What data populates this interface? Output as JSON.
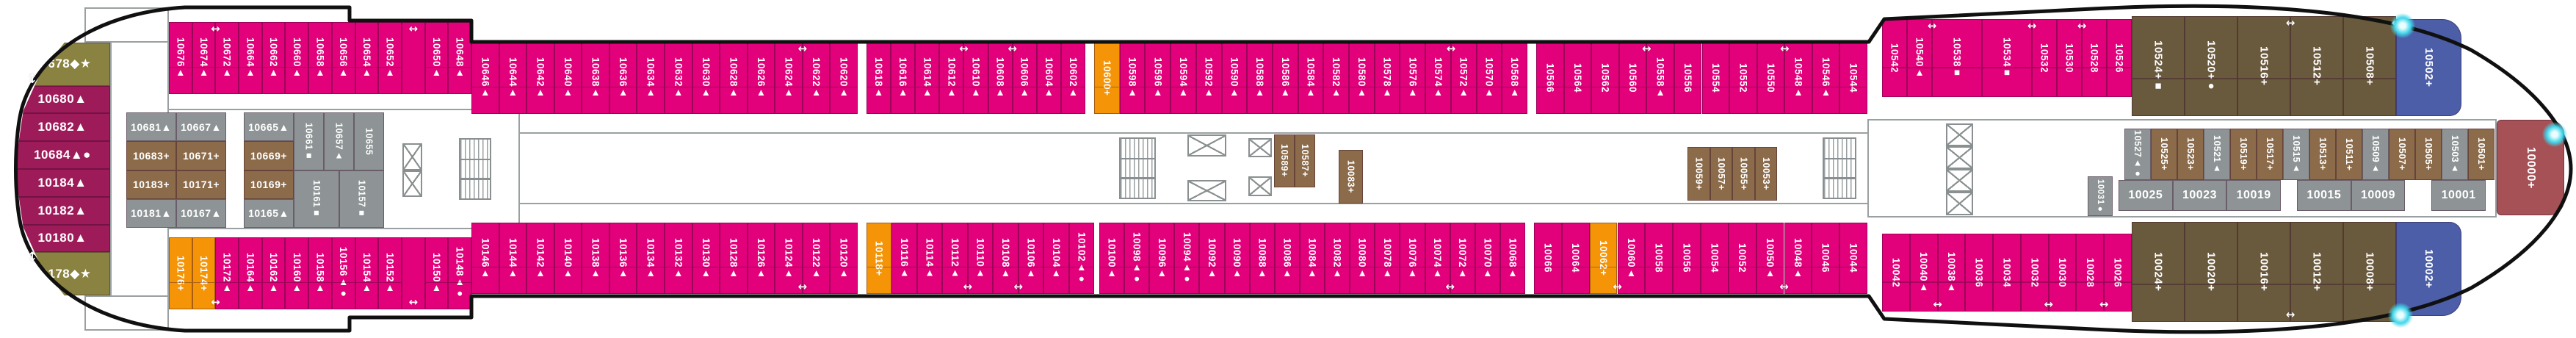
{
  "deck_plan_name": "cruise-ship-deck-10-cabin-plan",
  "icons": {
    "arrow_h": "↔",
    "arrow_v": "↕",
    "glow": "highlight-dot"
  },
  "colors": {
    "pink": "#e2017b",
    "berry": "#9e1b5a",
    "olive": "#8a8240",
    "gray": "#8e9495",
    "brown": "#8b6b4a",
    "hbrown": "#6a5a3d",
    "orange": "#f49406",
    "blue": "#4b5ea7",
    "red": "#a55156"
  },
  "cabins": {
    "lb": [
      {
        "n": "10678",
        "s": "◆★",
        "c": "olive",
        "hf": 1.55
      },
      {
        "n": "10680",
        "s": "▲",
        "c": "berry"
      },
      {
        "n": "10682",
        "s": "▲",
        "c": "berry"
      },
      {
        "n": "10684",
        "s": "▲●",
        "c": "berry"
      },
      {
        "n": "10184",
        "s": "▲",
        "c": "berry"
      },
      {
        "n": "10182",
        "s": "▲",
        "c": "berry"
      },
      {
        "n": "10180",
        "s": "▲",
        "c": "berry"
      },
      {
        "n": "10178",
        "s": "◆★",
        "c": "olive",
        "hf": 1.55
      }
    ],
    "t1": [
      {
        "n": "10676",
        "s": "▲",
        "c": "pink"
      },
      {
        "n": "10674",
        "s": "▲",
        "c": "pink",
        "a": 1
      },
      {
        "n": "10672",
        "s": "▲",
        "c": "pink"
      },
      {
        "n": "10664",
        "s": "▲",
        "c": "pink"
      },
      {
        "n": "10662",
        "s": "▲",
        "c": "pink"
      },
      {
        "n": "10660",
        "s": "▲",
        "c": "pink"
      },
      {
        "n": "10658",
        "s": "▲",
        "c": "pink"
      },
      {
        "n": "10656",
        "s": "▲",
        "c": "pink"
      },
      {
        "n": "10654",
        "s": "▲",
        "c": "pink"
      },
      {
        "n": "10652",
        "s": "▲",
        "c": "pink"
      },
      {
        "sp": 1,
        "c": "pink",
        "a": 1
      },
      {
        "n": "10650",
        "s": "▲",
        "c": "pink"
      },
      {
        "n": "10648",
        "s": "▲",
        "c": "pink"
      }
    ],
    "t2": [
      {
        "n": "10646",
        "s": "▲",
        "c": "pink"
      },
      {
        "n": "10644",
        "s": "▲",
        "c": "pink"
      },
      {
        "n": "10642",
        "s": "▲",
        "c": "pink"
      },
      {
        "n": "10640",
        "s": "▲",
        "c": "pink"
      },
      {
        "n": "10638",
        "s": "▲",
        "c": "pink"
      },
      {
        "n": "10636",
        "s": "▲",
        "c": "pink"
      },
      {
        "n": "10634",
        "s": "▲",
        "c": "pink"
      },
      {
        "n": "10632",
        "s": "▲",
        "c": "pink"
      },
      {
        "n": "10630",
        "s": "▲",
        "c": "pink"
      },
      {
        "n": "10628",
        "s": "▲",
        "c": "pink"
      },
      {
        "n": "10626",
        "s": "▲",
        "c": "pink"
      },
      {
        "n": "10624",
        "s": "▲",
        "c": "pink",
        "a": 1
      },
      {
        "n": "10622",
        "s": "▲",
        "c": "pink"
      },
      {
        "n": "10620",
        "s": "▲",
        "c": "pink"
      }
    ],
    "t3": [
      {
        "n": "10618",
        "s": "▲",
        "c": "pink"
      },
      {
        "n": "10616",
        "s": "▲",
        "c": "pink"
      },
      {
        "n": "10614",
        "s": "▲",
        "c": "pink"
      },
      {
        "n": "10612",
        "s": "▲",
        "c": "pink",
        "a": 1
      },
      {
        "n": "10610",
        "s": "▲",
        "c": "pink"
      },
      {
        "n": "10608",
        "s": "▲",
        "c": "pink",
        "a": 1
      },
      {
        "n": "10606",
        "s": "▲",
        "c": "pink"
      },
      {
        "n": "10604",
        "s": "▲",
        "c": "pink"
      },
      {
        "n": "10602",
        "s": "▲",
        "c": "pink"
      }
    ],
    "t4": [
      {
        "n": "10600",
        "s": "+",
        "c": "orange"
      },
      {
        "n": "10598",
        "s": "▲",
        "c": "pink"
      },
      {
        "n": "10596",
        "s": "▲",
        "c": "pink"
      },
      {
        "n": "10594",
        "s": "▲",
        "c": "pink"
      },
      {
        "n": "10592",
        "s": "▲",
        "c": "pink"
      },
      {
        "n": "10590",
        "s": "▲",
        "c": "pink"
      },
      {
        "n": "10588",
        "s": "▲",
        "c": "pink"
      },
      {
        "n": "10586",
        "s": "▲",
        "c": "pink"
      },
      {
        "n": "10584",
        "s": "▲",
        "c": "pink"
      },
      {
        "n": "10582",
        "s": "▲",
        "c": "pink"
      },
      {
        "n": "10580",
        "s": "▲",
        "c": "pink"
      },
      {
        "n": "10578",
        "s": "▲",
        "c": "pink"
      },
      {
        "n": "10576",
        "s": "▲",
        "c": "pink"
      },
      {
        "n": "10574",
        "s": "▲",
        "c": "pink",
        "a": 1
      },
      {
        "n": "10572",
        "s": "▲",
        "c": "pink"
      },
      {
        "n": "10570",
        "s": "▲",
        "c": "pink"
      },
      {
        "n": "10568",
        "s": "▲",
        "c": "pink"
      }
    ],
    "t5": [
      {
        "n": "10566",
        "s": "",
        "c": "pink"
      },
      {
        "n": "10564",
        "s": "",
        "c": "pink"
      },
      {
        "n": "10562",
        "s": "",
        "c": "pink"
      },
      {
        "n": "10560",
        "s": "",
        "c": "pink",
        "a": 1
      },
      {
        "n": "10558",
        "s": "▲",
        "c": "pink"
      },
      {
        "n": "10556",
        "s": "",
        "c": "pink"
      },
      {
        "n": "10554",
        "s": "",
        "c": "pink"
      },
      {
        "n": "10552",
        "s": "",
        "c": "pink"
      },
      {
        "n": "10550",
        "s": "",
        "c": "pink",
        "a": 1
      },
      {
        "n": "10548",
        "s": "▲",
        "c": "pink"
      },
      {
        "n": "10546",
        "s": "▲",
        "c": "pink"
      },
      {
        "n": "10544",
        "s": "",
        "c": "pink"
      }
    ],
    "t6": [
      {
        "n": "10542",
        "s": "",
        "c": "pink"
      },
      {
        "n": "10540",
        "s": "▲",
        "c": "pink",
        "a": 1
      },
      {
        "n": "10538",
        "s": "■",
        "c": "pink",
        "wf": 2
      },
      {
        "n": "10534",
        "s": "■",
        "c": "pink",
        "wf": 2,
        "a": 1
      },
      {
        "n": "10532",
        "s": "",
        "c": "pink"
      },
      {
        "n": "10530",
        "s": "",
        "c": "pink",
        "a": 1
      },
      {
        "n": "10528",
        "s": "",
        "c": "pink"
      },
      {
        "n": "10526",
        "s": "",
        "c": "pink"
      }
    ],
    "t7": [
      {
        "n": "10524",
        "s": "+■",
        "c": "hbrown"
      },
      {
        "n": "10520",
        "s": "+●",
        "c": "hbrown"
      },
      {
        "n": "10516",
        "s": "+",
        "c": "hbrown",
        "a": 1
      },
      {
        "n": "10512",
        "s": "+",
        "c": "hbrown"
      },
      {
        "n": "10508",
        "s": "+",
        "c": "hbrown",
        "a": 1
      }
    ],
    "t7b": [
      {
        "n": "10502",
        "s": "+",
        "c": "blue"
      }
    ],
    "b1": [
      {
        "n": "10176",
        "s": "+",
        "c": "orange"
      },
      {
        "n": "10174",
        "s": "+",
        "c": "orange",
        "a": 1
      },
      {
        "n": "10172",
        "s": "▲",
        "c": "pink"
      },
      {
        "n": "10164",
        "s": "▲",
        "c": "pink"
      },
      {
        "n": "10162",
        "s": "▲",
        "c": "pink"
      },
      {
        "n": "10160",
        "s": "▲",
        "c": "pink"
      },
      {
        "n": "10158",
        "s": "▲",
        "c": "pink"
      },
      {
        "n": "10156",
        "s": "▲●",
        "c": "pink"
      },
      {
        "n": "10154",
        "s": "▲",
        "c": "pink"
      },
      {
        "n": "10152",
        "s": "▲",
        "c": "pink"
      },
      {
        "sp": 1,
        "c": "pink",
        "a": 1
      },
      {
        "n": "10150",
        "s": "▲",
        "c": "pink"
      },
      {
        "n": "10148",
        "s": "▲●",
        "c": "pink"
      }
    ],
    "b2": [
      {
        "n": "10146",
        "s": "▲",
        "c": "pink"
      },
      {
        "n": "10144",
        "s": "▲",
        "c": "pink"
      },
      {
        "n": "10142",
        "s": "▲",
        "c": "pink"
      },
      {
        "n": "10140",
        "s": "▲",
        "c": "pink"
      },
      {
        "n": "10138",
        "s": "▲",
        "c": "pink"
      },
      {
        "n": "10136",
        "s": "▲",
        "c": "pink"
      },
      {
        "n": "10134",
        "s": "▲",
        "c": "pink"
      },
      {
        "n": "10132",
        "s": "▲",
        "c": "pink"
      },
      {
        "n": "10130",
        "s": "▲",
        "c": "pink"
      },
      {
        "n": "10128",
        "s": "▲",
        "c": "pink"
      },
      {
        "n": "10126",
        "s": "▲",
        "c": "pink"
      },
      {
        "n": "10124",
        "s": "▲",
        "c": "pink",
        "a": 1
      },
      {
        "n": "10122",
        "s": "▲",
        "c": "pink"
      },
      {
        "n": "10120",
        "s": "▲",
        "c": "pink"
      }
    ],
    "b3": [
      {
        "n": "10118",
        "s": "+",
        "c": "orange"
      },
      {
        "n": "10116",
        "s": "▲",
        "c": "pink"
      },
      {
        "n": "10114",
        "s": "▲",
        "c": "pink"
      },
      {
        "n": "10112",
        "s": "▲",
        "c": "pink",
        "a": 1
      },
      {
        "n": "10110",
        "s": "▲",
        "c": "pink"
      },
      {
        "n": "10108",
        "s": "▲",
        "c": "pink",
        "a": 1
      },
      {
        "n": "10106",
        "s": "▲",
        "c": "pink"
      },
      {
        "n": "10104",
        "s": "▲",
        "c": "pink"
      },
      {
        "n": "10102",
        "s": "▲●",
        "c": "pink"
      }
    ],
    "b4": [
      {
        "n": "10100",
        "s": "▲",
        "c": "pink"
      },
      {
        "n": "10098",
        "s": "▲●",
        "c": "pink"
      },
      {
        "n": "10096",
        "s": "▲",
        "c": "pink"
      },
      {
        "n": "10094",
        "s": "▲●",
        "c": "pink"
      },
      {
        "n": "10092",
        "s": "▲",
        "c": "pink"
      },
      {
        "n": "10090",
        "s": "▲",
        "c": "pink"
      },
      {
        "n": "10088",
        "s": "▲",
        "c": "pink"
      },
      {
        "n": "10086",
        "s": "▲",
        "c": "pink"
      },
      {
        "n": "10084",
        "s": "▲",
        "c": "pink"
      },
      {
        "n": "10082",
        "s": "▲",
        "c": "pink"
      },
      {
        "n": "10080",
        "s": "▲",
        "c": "pink"
      },
      {
        "n": "10078",
        "s": "▲",
        "c": "pink"
      },
      {
        "n": "10076",
        "s": "▲",
        "c": "pink"
      },
      {
        "n": "10074",
        "s": "▲",
        "c": "pink",
        "a": 1
      },
      {
        "n": "10072",
        "s": "▲",
        "c": "pink"
      },
      {
        "n": "10070",
        "s": "▲",
        "c": "pink"
      },
      {
        "n": "10068",
        "s": "▲",
        "c": "pink"
      }
    ],
    "b5": [
      {
        "n": "10066",
        "s": "",
        "c": "pink"
      },
      {
        "n": "10064",
        "s": "",
        "c": "pink"
      },
      {
        "n": "10062",
        "s": "+",
        "c": "orange",
        "a": 1
      },
      {
        "n": "10060",
        "s": "▲",
        "c": "pink"
      },
      {
        "n": "10058",
        "s": "",
        "c": "pink"
      },
      {
        "n": "10056",
        "s": "",
        "c": "pink"
      },
      {
        "n": "10054",
        "s": "",
        "c": "pink"
      },
      {
        "n": "10052",
        "s": "",
        "c": "pink"
      },
      {
        "n": "10050",
        "s": "▲",
        "c": "pink",
        "a": 1
      },
      {
        "n": "10048",
        "s": "▲",
        "c": "pink"
      },
      {
        "n": "10046",
        "s": "",
        "c": "pink"
      },
      {
        "n": "10044",
        "s": "",
        "c": "pink"
      }
    ],
    "b6": [
      {
        "n": "10042",
        "s": "",
        "c": "pink"
      },
      {
        "n": "10040",
        "s": "▲",
        "c": "pink",
        "a": 1
      },
      {
        "n": "10038",
        "s": "▲",
        "c": "pink"
      },
      {
        "n": "10036",
        "s": "",
        "c": "pink"
      },
      {
        "n": "10034",
        "s": "",
        "c": "pink"
      },
      {
        "n": "10032",
        "s": "",
        "c": "pink",
        "a": 1
      },
      {
        "n": "10030",
        "s": "",
        "c": "pink"
      },
      {
        "n": "10028",
        "s": "",
        "c": "pink",
        "a": 1
      },
      {
        "n": "10026",
        "s": "",
        "c": "pink"
      }
    ],
    "b7": [
      {
        "n": "10024",
        "s": "+",
        "c": "hbrown"
      },
      {
        "n": "10020",
        "s": "+",
        "c": "hbrown"
      },
      {
        "n": "10016",
        "s": "+",
        "c": "hbrown",
        "a": 1
      },
      {
        "n": "10012",
        "s": "+",
        "c": "hbrown"
      },
      {
        "n": "10008",
        "s": "+",
        "c": "hbrown",
        "a": 1
      }
    ],
    "b7b": [
      {
        "n": "10002",
        "s": "+",
        "c": "blue"
      }
    ],
    "c1": [
      {
        "n": "10681",
        "s": "▲",
        "c": "gray"
      },
      {
        "n": "10683",
        "s": "+",
        "c": "brown"
      },
      {
        "n": "10183",
        "s": "+",
        "c": "brown"
      },
      {
        "n": "10181",
        "s": "▲",
        "c": "gray"
      }
    ],
    "c2": [
      {
        "n": "10667",
        "s": "▲",
        "c": "gray"
      },
      {
        "n": "10671",
        "s": "+",
        "c": "brown"
      },
      {
        "n": "10171",
        "s": "+",
        "c": "brown"
      },
      {
        "n": "10167",
        "s": "▲",
        "c": "gray"
      }
    ],
    "c3": [
      {
        "n": "10665",
        "s": "▲",
        "c": "gray"
      },
      {
        "n": "10669",
        "s": "+",
        "c": "brown"
      },
      {
        "n": "10169",
        "s": "+",
        "c": "brown"
      },
      {
        "n": "10165",
        "s": "▲",
        "c": "gray"
      }
    ],
    "vc1": [
      {
        "n": "10661",
        "s": "■",
        "c": "gray"
      },
      {
        "n": "10657",
        "s": "▲",
        "c": "gray"
      },
      {
        "n": "10655",
        "s": "",
        "c": "gray"
      }
    ],
    "vc2": [
      {
        "n": "10161",
        "s": "■",
        "c": "gray"
      },
      {
        "n": "10157",
        "s": "■",
        "c": "gray"
      }
    ],
    "m1": [
      {
        "n": "10589",
        "s": "+",
        "c": "brown"
      },
      {
        "n": "10587",
        "s": "+",
        "c": "brown"
      }
    ],
    "m2": [
      {
        "n": "10083",
        "s": "+",
        "c": "brown"
      }
    ],
    "m3": [
      {
        "n": "10059",
        "s": "+",
        "c": "brown"
      },
      {
        "n": "10057",
        "s": "+",
        "c": "brown"
      },
      {
        "n": "10055",
        "s": "+",
        "c": "brown"
      },
      {
        "n": "10053",
        "s": "+",
        "c": "brown"
      }
    ],
    "sv": [
      {
        "n": "10527",
        "s": "▲●",
        "c": "gray"
      },
      {
        "n": "10525",
        "s": "+",
        "c": "brown"
      },
      {
        "n": "10523",
        "s": "+",
        "c": "brown"
      },
      {
        "n": "10521",
        "s": "▲",
        "c": "gray"
      },
      {
        "n": "10519",
        "s": "+",
        "c": "brown"
      },
      {
        "n": "10517",
        "s": "+",
        "c": "brown"
      },
      {
        "n": "10515",
        "s": "▲",
        "c": "gray"
      },
      {
        "n": "10513",
        "s": "+",
        "c": "brown"
      },
      {
        "n": "10511",
        "s": "+",
        "c": "brown"
      },
      {
        "n": "10509",
        "s": "▲",
        "c": "gray"
      },
      {
        "n": "10507",
        "s": "+",
        "c": "brown"
      },
      {
        "n": "10505",
        "s": "+",
        "c": "brown"
      },
      {
        "n": "10503",
        "s": "▲",
        "c": "gray"
      },
      {
        "n": "10501",
        "s": "+",
        "c": "brown"
      }
    ],
    "sg": [
      {
        "n": "10025",
        "s": "",
        "c": "gray"
      },
      {
        "n": "10023",
        "s": "",
        "c": "gray"
      },
      {
        "n": "10019",
        "s": "",
        "c": "gray"
      },
      {
        "n": "10015",
        "s": "",
        "c": "gray",
        "ml": 22
      },
      {
        "n": "10009",
        "s": "",
        "c": "gray"
      },
      {
        "n": "10001",
        "s": "",
        "c": "gray",
        "ml": 36
      }
    ],
    "s31": [
      {
        "n": "10031",
        "s": "●",
        "c": "gray"
      }
    ],
    "red": [
      {
        "n": "10000",
        "s": "+",
        "c": "red"
      }
    ]
  }
}
